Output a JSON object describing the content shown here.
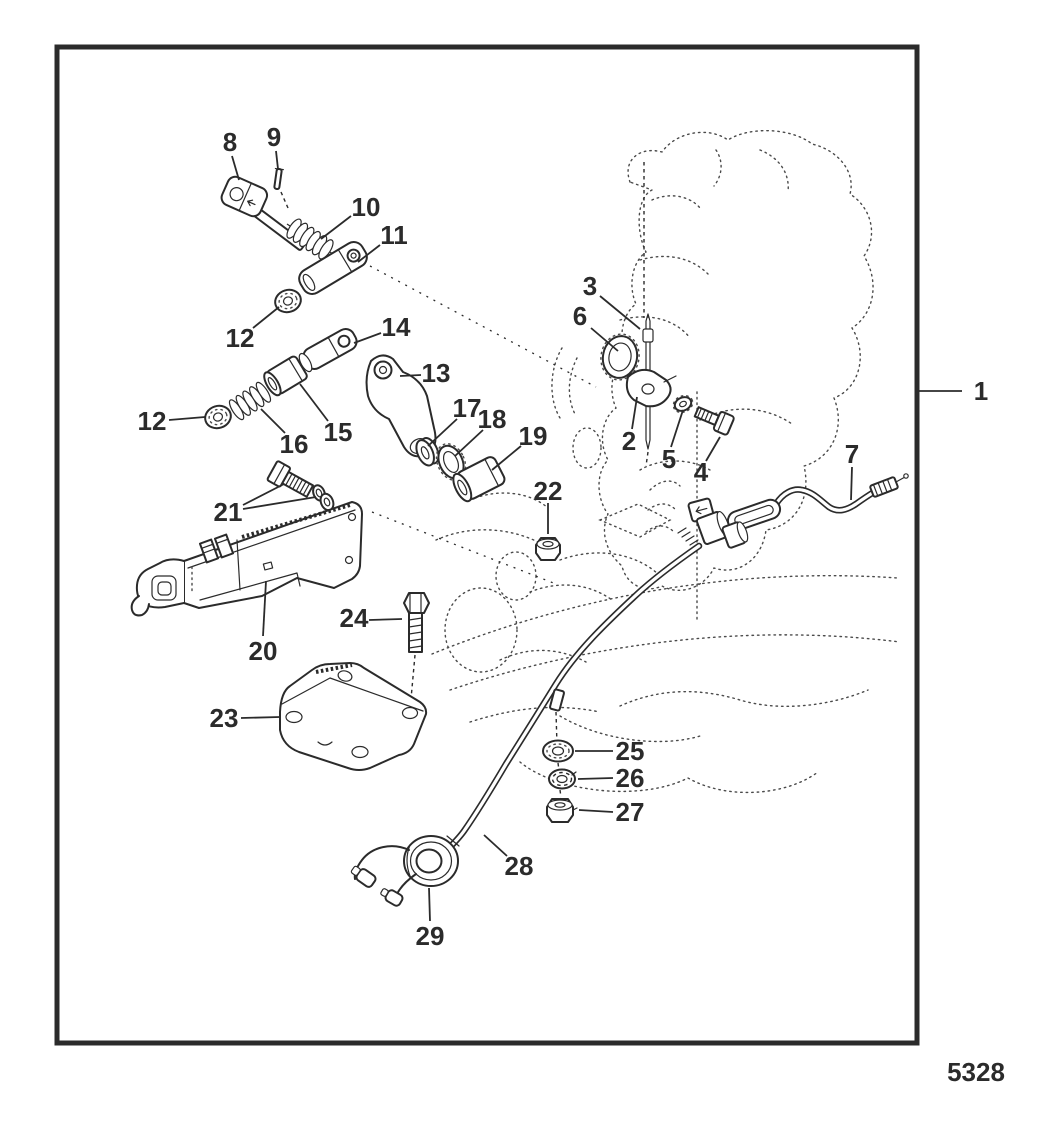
{
  "figure": {
    "number": "5328"
  },
  "style": {
    "line_color": "#2b2b2b",
    "background": "#ffffff"
  },
  "callouts": [
    {
      "label": "1",
      "tx": 981,
      "ty": 391,
      "leaders": [
        [
          [
            918,
            391
          ],
          [
            962,
            391
          ]
        ]
      ]
    },
    {
      "label": "2",
      "tx": 629,
      "ty": 441,
      "leaders": [
        [
          [
            632,
            429
          ],
          [
            637,
            397
          ]
        ]
      ]
    },
    {
      "label": "3",
      "tx": 590,
      "ty": 286,
      "leaders": [
        [
          [
            600,
            296
          ],
          [
            640,
            329
          ]
        ]
      ]
    },
    {
      "label": "4",
      "tx": 701,
      "ty": 472,
      "leaders": [
        [
          [
            706,
            461
          ],
          [
            720,
            437
          ]
        ]
      ]
    },
    {
      "label": "5",
      "tx": 669,
      "ty": 459,
      "leaders": [
        [
          [
            671,
            447
          ],
          [
            683,
            410
          ]
        ]
      ]
    },
    {
      "label": "6",
      "tx": 580,
      "ty": 316,
      "leaders": [
        [
          [
            591,
            328
          ],
          [
            618,
            351
          ]
        ]
      ]
    },
    {
      "label": "7",
      "tx": 852,
      "ty": 454,
      "leaders": [
        [
          [
            852,
            467
          ],
          [
            851,
            500
          ]
        ]
      ]
    },
    {
      "label": "8",
      "tx": 230,
      "ty": 142,
      "leaders": [
        [
          [
            232,
            156
          ],
          [
            239,
            180
          ]
        ]
      ]
    },
    {
      "label": "9",
      "tx": 274,
      "ty": 137,
      "leaders": [
        [
          [
            276,
            151
          ],
          [
            278,
            169
          ]
        ]
      ]
    },
    {
      "label": "10",
      "tx": 366,
      "ty": 207,
      "leaders": [
        [
          [
            351,
            216
          ],
          [
            321,
            239
          ]
        ]
      ]
    },
    {
      "label": "11",
      "tx": 394,
      "ty": 235,
      "leaders": [
        [
          [
            380,
            245
          ],
          [
            358,
            262
          ]
        ]
      ]
    },
    {
      "label": "12",
      "tx": 240,
      "ty": 338,
      "leaders": [
        [
          [
            253,
            328
          ],
          [
            279,
            307
          ]
        ]
      ]
    },
    {
      "label": "12",
      "tx": 152,
      "ty": 421,
      "leaders": [
        [
          [
            169,
            420
          ],
          [
            205,
            417
          ]
        ]
      ]
    },
    {
      "label": "13",
      "tx": 436,
      "ty": 373,
      "leaders": [
        [
          [
            421,
            375
          ],
          [
            400,
            376
          ]
        ]
      ]
    },
    {
      "label": "14",
      "tx": 396,
      "ty": 327,
      "leaders": [
        [
          [
            381,
            333
          ],
          [
            354,
            343
          ]
        ]
      ]
    },
    {
      "label": "15",
      "tx": 338,
      "ty": 432,
      "leaders": [
        [
          [
            328,
            421
          ],
          [
            300,
            384
          ]
        ]
      ]
    },
    {
      "label": "16",
      "tx": 294,
      "ty": 444,
      "leaders": [
        [
          [
            285,
            433
          ],
          [
            261,
            409
          ]
        ]
      ]
    },
    {
      "label": "17",
      "tx": 467,
      "ty": 408,
      "leaders": [
        [
          [
            457,
            419
          ],
          [
            428,
            446
          ]
        ]
      ]
    },
    {
      "label": "18",
      "tx": 492,
      "ty": 419,
      "leaders": [
        [
          [
            483,
            430
          ],
          [
            455,
            456
          ]
        ]
      ]
    },
    {
      "label": "19",
      "tx": 533,
      "ty": 436,
      "leaders": [
        [
          [
            521,
            446
          ],
          [
            492,
            470
          ]
        ]
      ]
    },
    {
      "label": "20",
      "tx": 263,
      "ty": 651,
      "leaders": [
        [
          [
            263,
            636
          ],
          [
            266,
            581
          ]
        ]
      ]
    },
    {
      "label": "21",
      "tx": 228,
      "ty": 512,
      "leaders": [
        [
          [
            243,
            505
          ],
          [
            284,
            484
          ]
        ],
        [
          [
            243,
            509
          ],
          [
            316,
            497
          ]
        ]
      ]
    },
    {
      "label": "22",
      "tx": 548,
      "ty": 491,
      "leaders": [
        [
          [
            548,
            503
          ],
          [
            548,
            534
          ]
        ]
      ]
    },
    {
      "label": "23",
      "tx": 224,
      "ty": 718,
      "leaders": [
        [
          [
            241,
            718
          ],
          [
            280,
            717
          ]
        ]
      ]
    },
    {
      "label": "24",
      "tx": 354,
      "ty": 618,
      "leaders": [
        [
          [
            369,
            620
          ],
          [
            402,
            619
          ]
        ]
      ]
    },
    {
      "label": "25",
      "tx": 630,
      "ty": 751,
      "leaders": [
        [
          [
            613,
            751
          ],
          [
            575,
            751
          ]
        ]
      ]
    },
    {
      "label": "26",
      "tx": 630,
      "ty": 778,
      "leaders": [
        [
          [
            613,
            778
          ],
          [
            578,
            779
          ]
        ]
      ]
    },
    {
      "label": "27",
      "tx": 630,
      "ty": 812,
      "leaders": [
        [
          [
            613,
            812
          ],
          [
            579,
            810
          ]
        ]
      ]
    },
    {
      "label": "28",
      "tx": 519,
      "ty": 866,
      "leaders": [
        [
          [
            507,
            856
          ],
          [
            484,
            835
          ]
        ]
      ]
    },
    {
      "label": "29",
      "tx": 430,
      "ty": 936,
      "leaders": [
        [
          [
            430,
            921
          ],
          [
            429,
            888
          ]
        ]
      ]
    }
  ]
}
